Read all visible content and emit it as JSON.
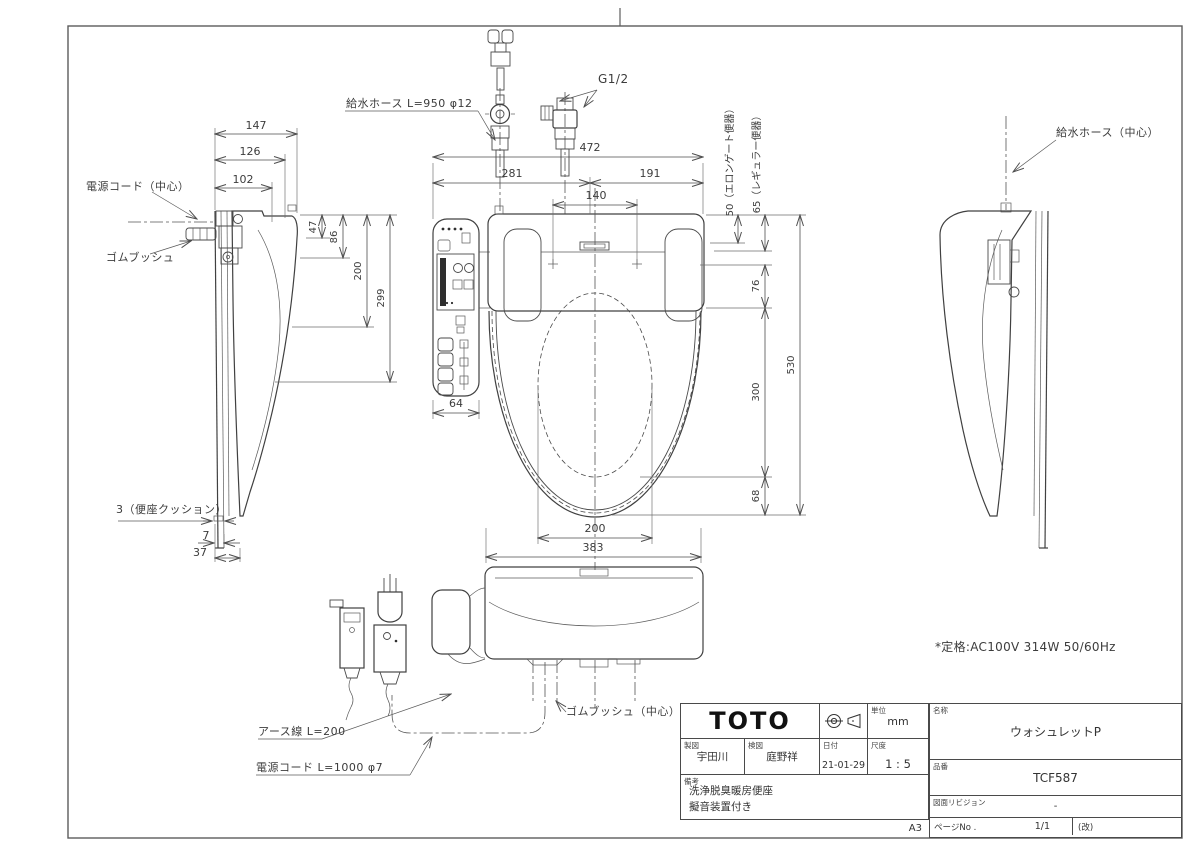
{
  "frame": {
    "sheet_size": "A3"
  },
  "callouts": {
    "power_cord_center": "電源コード（中心）",
    "rubber_bush": "ゴムブッシュ",
    "supply_hose_top": "給水ホース L=950 φ12",
    "thread_size": "G1/2",
    "supply_hose_center": "給水ホース（中心）",
    "seat_cushion": "3（便座クッション）",
    "rubber_bush_center": "ゴムブッシュ（中心）",
    "earth_wire": "アース線 L=200",
    "power_cord_bottom": "電源コード L=1000 φ7",
    "rating": "*定格:AC100V 314W 50/60Hz"
  },
  "dims": {
    "side": {
      "d147": "147",
      "d126": "126",
      "d102": "102",
      "d47": "47",
      "d86": "86",
      "d200": "200",
      "d299": "299",
      "d7": "7",
      "d37": "37"
    },
    "plan": {
      "d472": "472",
      "d281": "281",
      "d191": "191",
      "d140": "140",
      "d64": "64",
      "d50_elongated": "50（エロンゲート便器）",
      "d65_regular": "65（レギュラー便器）",
      "d76": "76",
      "d300": "300",
      "d68": "68",
      "d530": "530",
      "d200": "200",
      "d383": "383"
    }
  },
  "title_block": {
    "company": "TOTO",
    "unit_label": "単位",
    "unit_value": "mm",
    "drafter_label": "製図",
    "drafter": "宇田川",
    "checker_label": "検図",
    "checker": "庭野祥",
    "date_label": "日付",
    "date": "21-01-29",
    "scale_label": "尺度",
    "scale": "1 : 5",
    "name_label": "名称",
    "product_name": "ウォシュレットP",
    "part_label": "品番",
    "part_number": "TCF587",
    "revision_label": "図面リビジョン",
    "revision": "-",
    "remarks_label": "備考",
    "remarks_line1": "洗浄脱臭暖房便座",
    "remarks_line2": "擬音装置付き",
    "sheet_size": "A3",
    "page_label": "ページNo .",
    "page_value": "1/1",
    "revision_mark": "(改)"
  }
}
